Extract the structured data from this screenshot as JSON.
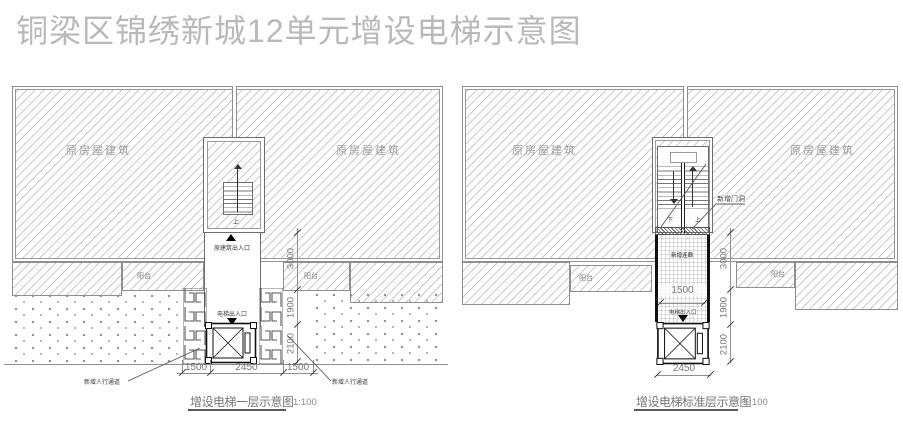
{
  "page_title": "铜梁区锦绣新城12单元增设电梯示意图",
  "colors": {
    "line": "#8a8a8a",
    "dark": "#111111",
    "label": "#9a9a9a",
    "dim": "#777777"
  },
  "left": {
    "title": "增设电梯一层示意图",
    "scale": "1:100",
    "building_label": "原房屋建筑",
    "balcony_label": "阳台",
    "original_entrance": "原建筑出入口",
    "elevator_entrance": "电梯出入口",
    "stair_up": "上",
    "walkway_label": "新增人行通道",
    "hdims": [
      "1500",
      "2450",
      "1500"
    ],
    "vdims": [
      "3000",
      "1900",
      "2100"
    ]
  },
  "right": {
    "title": "增设电梯标准层示意图",
    "scale": "1:100",
    "building_label": "原房屋建筑",
    "balcony_label": "阳台",
    "door_opening_label": "新增门洞",
    "corridor_label": "新增连廊",
    "elevator_entrance": "电梯出入口",
    "stair_up": "上",
    "stair_down": "下",
    "corridor_width": "1500",
    "shaft_width": "2450",
    "vdims": [
      "3000",
      "1900",
      "2100"
    ]
  }
}
